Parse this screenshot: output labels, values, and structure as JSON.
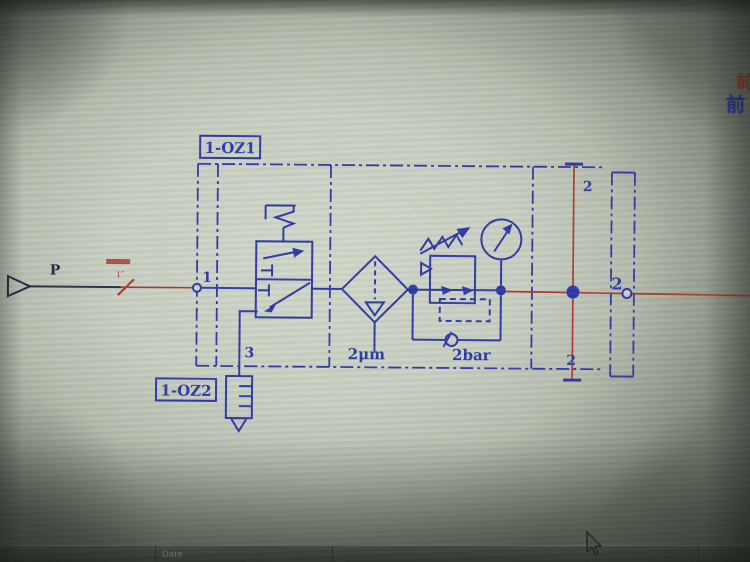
{
  "schematic": {
    "unit_tags": {
      "main": "1-OZ1",
      "silencer": "1-OZ2"
    },
    "ports": {
      "supply": "P",
      "inlet": "1",
      "outlet": "2",
      "exhaust": "3"
    },
    "branch_labels": {
      "top": "2",
      "bottom": "2"
    },
    "component_values": {
      "filter_rating": "2μm",
      "regulator_setting": "2bar"
    },
    "pipe_note_size": "1″"
  },
  "screen": {
    "corner_char_blue": "前",
    "corner_char_red": "前",
    "titleblock": {
      "date_label": "Date"
    }
  },
  "colors": {
    "line_blue": "#2b36a3",
    "line_red": "#b03527",
    "paper": "#cbd2c5"
  }
}
